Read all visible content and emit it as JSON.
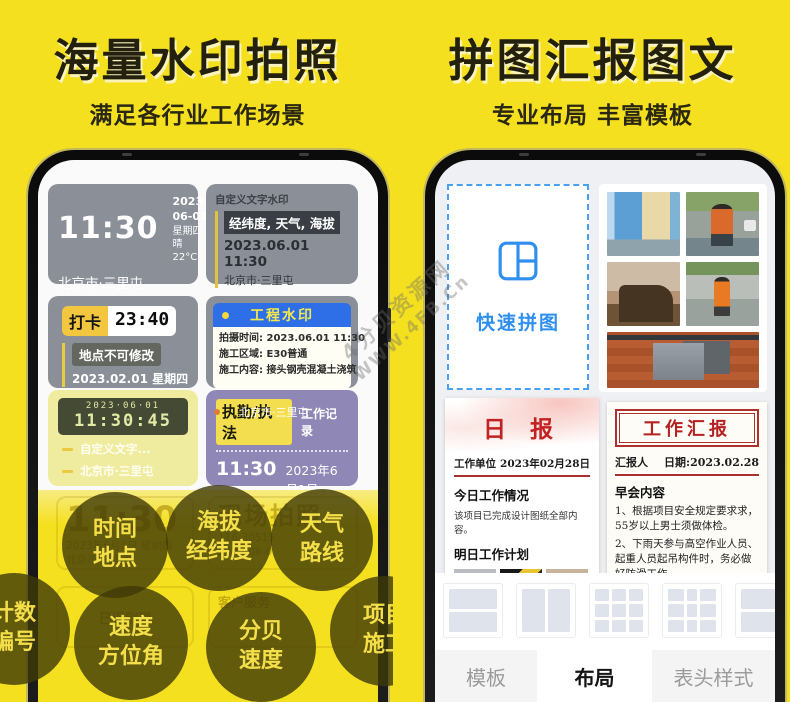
{
  "colors": {
    "background": "#F5E01F",
    "accent_blue": "#2F8FEF",
    "header_blue": "#2E6FE8",
    "card_gray": "#8A8F98",
    "card_purple": "#8F87B6",
    "tag_yellow": "#F2DE4E",
    "report_red": "#B52020"
  },
  "watermark": {
    "line1": "4分贝资源网",
    "line2": "WWW.4FB.Cn"
  },
  "left_panel": {
    "title": "海量水印拍照",
    "subtitle": "满足各行业工作场景",
    "widgets": {
      "time_card": {
        "time": "11:30",
        "date": "2023-06-01",
        "weekday_weather": "星期四 晴 22°C",
        "location": "北京市·三里屯"
      },
      "custom_text_card": {
        "label": "自定义文字水印",
        "highlight": "经纬度, 天气, 海拔",
        "datetime": "2023.06.01  11:30",
        "location": "北京市·三里屯"
      },
      "punch_card": {
        "tag": "打卡",
        "time": "23:40",
        "note": "地点不可修改",
        "date": "2023.02.01 星期四"
      },
      "engineering_card": {
        "title": "工程水印",
        "rows": [
          {
            "label": "拍摄时间:",
            "value": "2023.06.01 11:30"
          },
          {
            "label": "施工区域:",
            "value": "E30普通"
          },
          {
            "label": "施工内容:",
            "value": "接头钢壳混凝土浇筑"
          }
        ]
      },
      "lcd_card": {
        "date": "2023·06·01",
        "time": "11:30:45",
        "line1": "自定义文字...",
        "line2": "北京市·三里屯"
      },
      "duty_card": {
        "tag": "执勤/执法",
        "label": "工作记录",
        "time": "11:30",
        "date": "2023年6月1日",
        "location": "北京市·三里屯"
      }
    },
    "ghost": {
      "time": "11:30",
      "date": "2023年6月1日 星期四",
      "location": "北京市·三里屯",
      "headline": "现场拍照",
      "coord": "116.30515",
      "date2": "2023-06-0",
      "recognized": "已识别到",
      "service": "客户服务"
    },
    "bubbles": [
      {
        "line1": "时间",
        "line2": "地点"
      },
      {
        "line1": "海拔",
        "line2": "经纬度"
      },
      {
        "line1": "天气",
        "line2": "路线"
      },
      {
        "line1": "计数",
        "line2": "编号"
      },
      {
        "line1": "速度",
        "line2": "方位角"
      },
      {
        "line1": "分贝",
        "line2": "速度"
      },
      {
        "line1": "项目",
        "line2": "施工"
      }
    ]
  },
  "right_panel": {
    "title": "拼图汇报图文",
    "subtitle": "专业布局 丰富模板",
    "quick_collage": {
      "label": "快速拼图"
    },
    "daily_report": {
      "title": "日 报",
      "unit_label": "工作单位",
      "date": "2023年02月28日",
      "section1": "今日工作情况",
      "body1": "该项目已完成设计图纸全部内容。",
      "section2": "明日工作计划"
    },
    "work_report": {
      "title": "工作汇报",
      "reporter_label": "汇报人",
      "date_label": "日期:2023.02.28",
      "section": "早会内容",
      "para1": "1、根据项目安全规定要求求，55岁以上男士须做体检。",
      "para2": "2、下雨天参与高空作业人员、起重人员起吊构件时，务必做好防滑工作。",
      "caption": "严格排查施工 现场生命线景"
    },
    "tabs": [
      {
        "label": "模板"
      },
      {
        "label": "布局"
      },
      {
        "label": "表头样式"
      }
    ]
  }
}
